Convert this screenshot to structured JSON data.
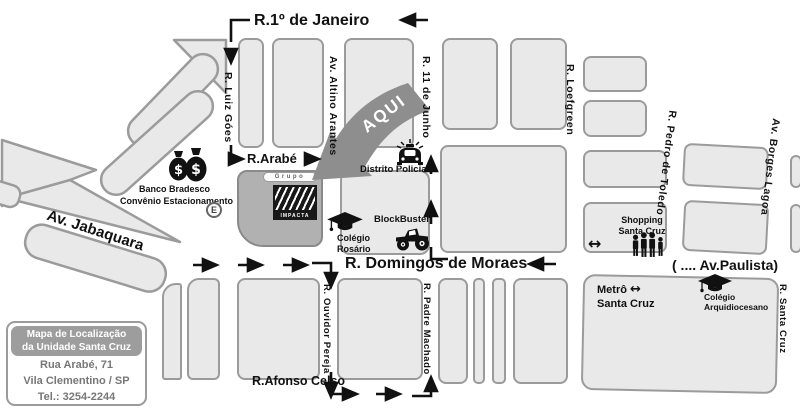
{
  "map": {
    "streets": {
      "r_1_de_janeiro": "R.1º de Janeiro",
      "r_luiz_goes": "R. Luiz Góes",
      "av_altino_arantes": "Av. Altino Arantes",
      "r_11_de_junho": "R. 11 de Junho",
      "r_loefgreen": "R. Loefgreen",
      "r_pedro_de_toledo": "R. Pedro de Toledo",
      "av_borges_lagoa": "Av. Borges Lagoa",
      "r_arabe": "R.Arabé",
      "av_jabaquara": "Av. Jabaquara",
      "r_domingos_de_moraes": "R. Domingos de Moraes",
      "av_paulista": "( .... Av.Paulista)",
      "r_ouvidor_pereja": "R. Ouvidor Pereja",
      "r_padre_machado": "R. Padre Machado",
      "r_afonso_celso": "R.Afonso Celso",
      "r_santa_cruz": "R. Santa Cruz"
    },
    "marker": {
      "aqui": "AQUI",
      "grupo": "Grupo",
      "impacta": "IMPACTA"
    },
    "pois": {
      "banco_line1": "Banco Bradesco",
      "banco_line2": "Convênio Estacionamento",
      "parking_badge": "E",
      "distrito_policial": "Distrito Policial",
      "colegio_rosario_line1": "Colégio",
      "colegio_rosario_line2": "Rosário",
      "blockbuster": "BlockBuster",
      "shopping_line1": "Shopping",
      "shopping_line2": "Santa Cruz",
      "metro_line1": "Metrô",
      "metro_line2": "Santa Cruz",
      "metro_symbol": "↔",
      "colegio_arq_line1": "Colégio",
      "colegio_arq_line2": "Arquidiocesano"
    },
    "info_box": {
      "title_line1": "Mapa de Localização",
      "title_line2": "da Unidade Santa Cruz",
      "address_line1": "Rua Arabé, 71",
      "address_line2": "Vila Clementino / SP",
      "phone": "Tel.: 3254-2244"
    },
    "colors": {
      "block_fill": "#e9e9e9",
      "block_border": "#9b9b9b",
      "impacta_block_fill": "#b1b1b1",
      "aqui_arrow": "#8e8e8e",
      "info_header_bg": "#9d9d9d",
      "info_text": "#777777",
      "street_text": "#111111"
    }
  }
}
